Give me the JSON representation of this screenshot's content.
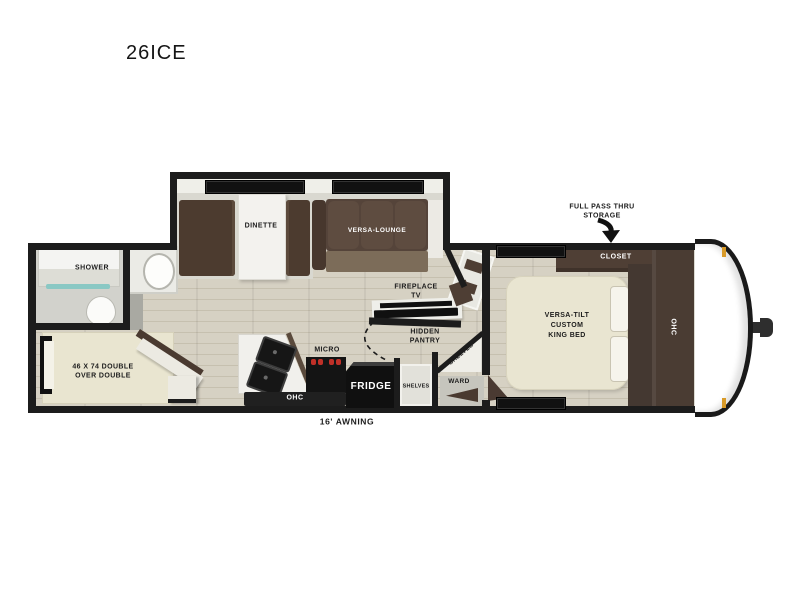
{
  "title": "26ICE",
  "slideout": {
    "dinette_label": "DINETTE",
    "versa_lounge_label": "VERSA-LOUNGE"
  },
  "bathroom": {
    "shower_label": "SHOWER"
  },
  "bunk": {
    "line1": "46 X 74 DOUBLE",
    "line2": "OVER DOUBLE"
  },
  "kitchen": {
    "micro_label": "MICRO",
    "fridge_label": "FRIDGE",
    "ohc_label": "OHC"
  },
  "midship": {
    "fireplace_line1": "FIREPLACE",
    "fireplace_line2": "TV",
    "pantry_line1": "HIDDEN",
    "pantry_line2": "PANTRY",
    "shelves_corner_label": "SHELVES",
    "shelves_small_label": "SHELVES",
    "ward_label": "WARD"
  },
  "bedroom": {
    "closet_label": "CLOSET",
    "ohc_label": "OHC",
    "bed_line1": "VERSA-TILT",
    "bed_line2": "CUSTOM",
    "bed_line3": "KING BED"
  },
  "callouts": {
    "storage_line1": "FULL PASS THRU",
    "storage_line2": "STORAGE",
    "awning_label": "16' AWNING"
  },
  "colors": {
    "wall": "#1c1c1c",
    "wood_floor": "#d5d0c2",
    "slide_floor": "#d9d8d0",
    "furniture_brown": "#4f3f35",
    "bed_cream": "#e9e5d1",
    "appliance_black": "#101010",
    "burner_red": "#c03028",
    "marker_amber": "#d89a28",
    "shower_teal": "#8ac8c4"
  }
}
